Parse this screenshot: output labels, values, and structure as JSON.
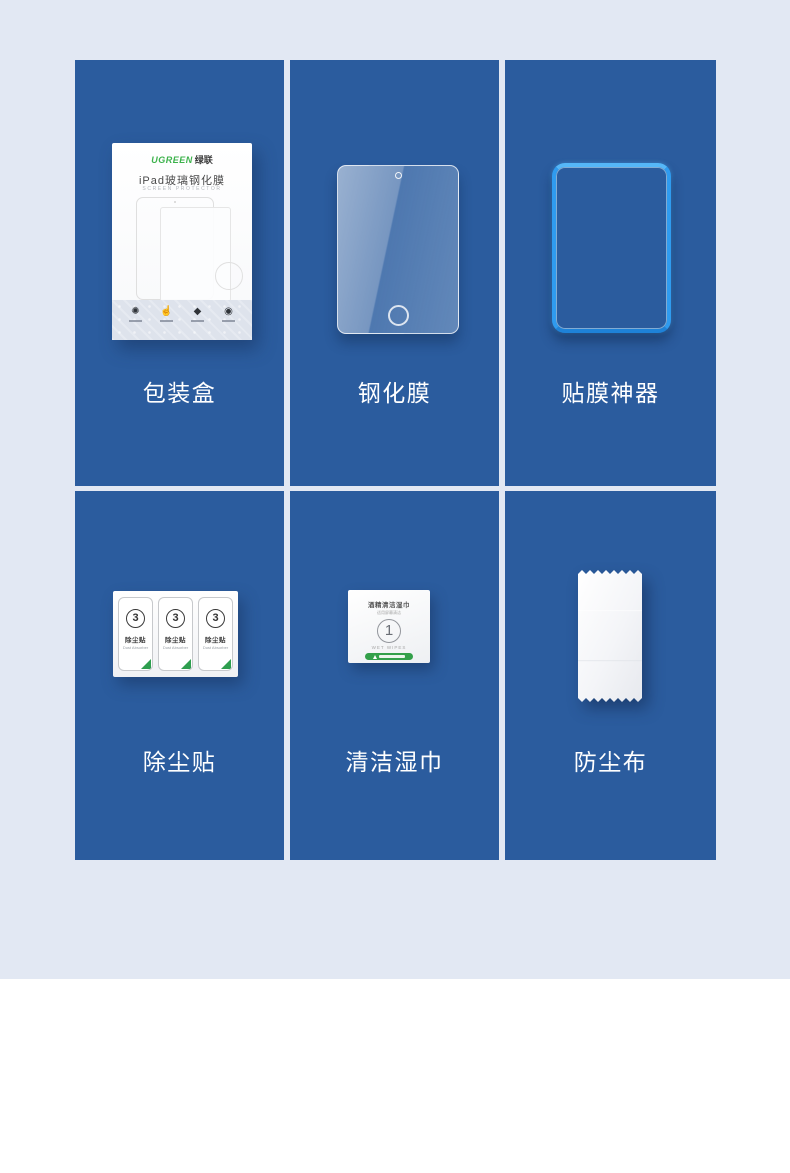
{
  "page": {
    "colors": {
      "tile_blue": "#2b5c9e",
      "page_background": "#e2e8f3",
      "lower_background": "#ffffff",
      "label_text": "#ffffff",
      "applicator_blue": "#2f9bef",
      "brand_green": "#3cb24b",
      "accent_green": "#2e9e4f"
    }
  },
  "items": [
    {
      "label": "包装盒"
    },
    {
      "label": "钢化膜"
    },
    {
      "label": "贴膜神器"
    },
    {
      "label": "除尘贴"
    },
    {
      "label": "清洁湿巾"
    },
    {
      "label": "防尘布"
    }
  ],
  "box": {
    "brand_en": "UGREEN",
    "brand_cn": "绿联",
    "title": "iPad玻璃钢化膜",
    "subtitle": "SCREEN PROTECTOR",
    "feature_icons": [
      {
        "name": "gear-icon",
        "glyph": "✺"
      },
      {
        "name": "touch-icon",
        "glyph": "☝"
      },
      {
        "name": "diamond-icon",
        "glyph": "◆"
      },
      {
        "name": "eye-icon",
        "glyph": "◉"
      }
    ]
  },
  "dust_sticker": {
    "number": "3",
    "label": "除尘贴",
    "sublabel": "Dust Absorber"
  },
  "wipe": {
    "title": "酒精清洁湿巾",
    "subtitle": "适用屏幕清洁",
    "number": "1",
    "caption": "WET WIPES"
  }
}
